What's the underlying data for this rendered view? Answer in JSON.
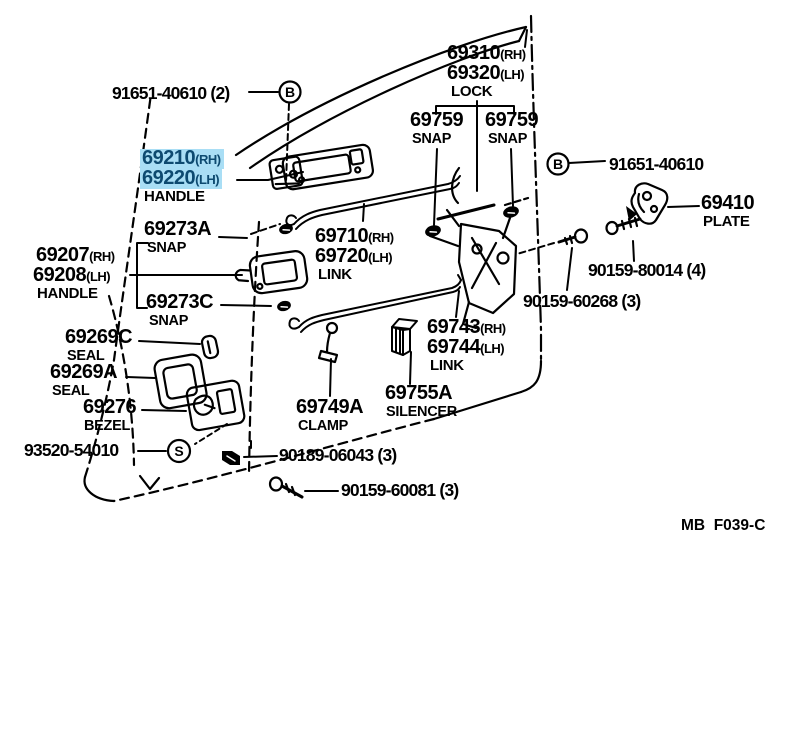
{
  "colors": {
    "line": "#000000",
    "highlight_bg": "#a9def5",
    "highlight_fg": "#0d4a70"
  },
  "footer_code": "MB  F039-C",
  "callouts": {
    "circle_b": "B",
    "circle_s": "S",
    "bolt_top": "91651-40610 (2)",
    "bolt_right": "91651-40610",
    "lock": {
      "rh_num": "69310",
      "rh": "(RH)",
      "lh_num": "69320",
      "lh": "(LH)",
      "name": "LOCK"
    },
    "snap_759": {
      "num": "69759",
      "name": "SNAP"
    },
    "outer_handle": {
      "rh_num": "69210",
      "rh": "(RH)",
      "lh_num": "69220",
      "lh": "(LH)",
      "name": "HANDLE"
    },
    "plate": {
      "num": "69410",
      "name": "PLATE"
    },
    "snap_a": {
      "num": "69273A",
      "name": "SNAP"
    },
    "snap_c": {
      "num": "69273C",
      "name": "SNAP"
    },
    "inner_handle": {
      "rh_num": "69207",
      "rh": "(RH)",
      "lh_num": "69208",
      "lh": "(LH)",
      "name": "HANDLE"
    },
    "link_upper": {
      "rh_num": "69710",
      "rh": "(RH)",
      "lh_num": "69720",
      "lh": "(LH)",
      "name": "LINK"
    },
    "link_lower": {
      "rh_num": "69743",
      "rh": "(RH)",
      "lh_num": "69744",
      "lh": "(LH)",
      "name": "LINK"
    },
    "screw_80014": "90159-80014 (4)",
    "screw_60268": "90159-60268 (3)",
    "seal_c": {
      "num": "69269C",
      "name": "SEAL"
    },
    "seal_a": {
      "num": "69269A",
      "name": "SEAL"
    },
    "bezel": {
      "num": "69276",
      "name": "BEZEL"
    },
    "clamp": {
      "num": "69749A",
      "name": "CLAMP"
    },
    "silencer": {
      "num": "69755A",
      "name": "SILENCER"
    },
    "screw_93520": "93520-54010",
    "grommet": "90189-06043 (3)",
    "screw_60081": "90159-60081 (3)"
  }
}
